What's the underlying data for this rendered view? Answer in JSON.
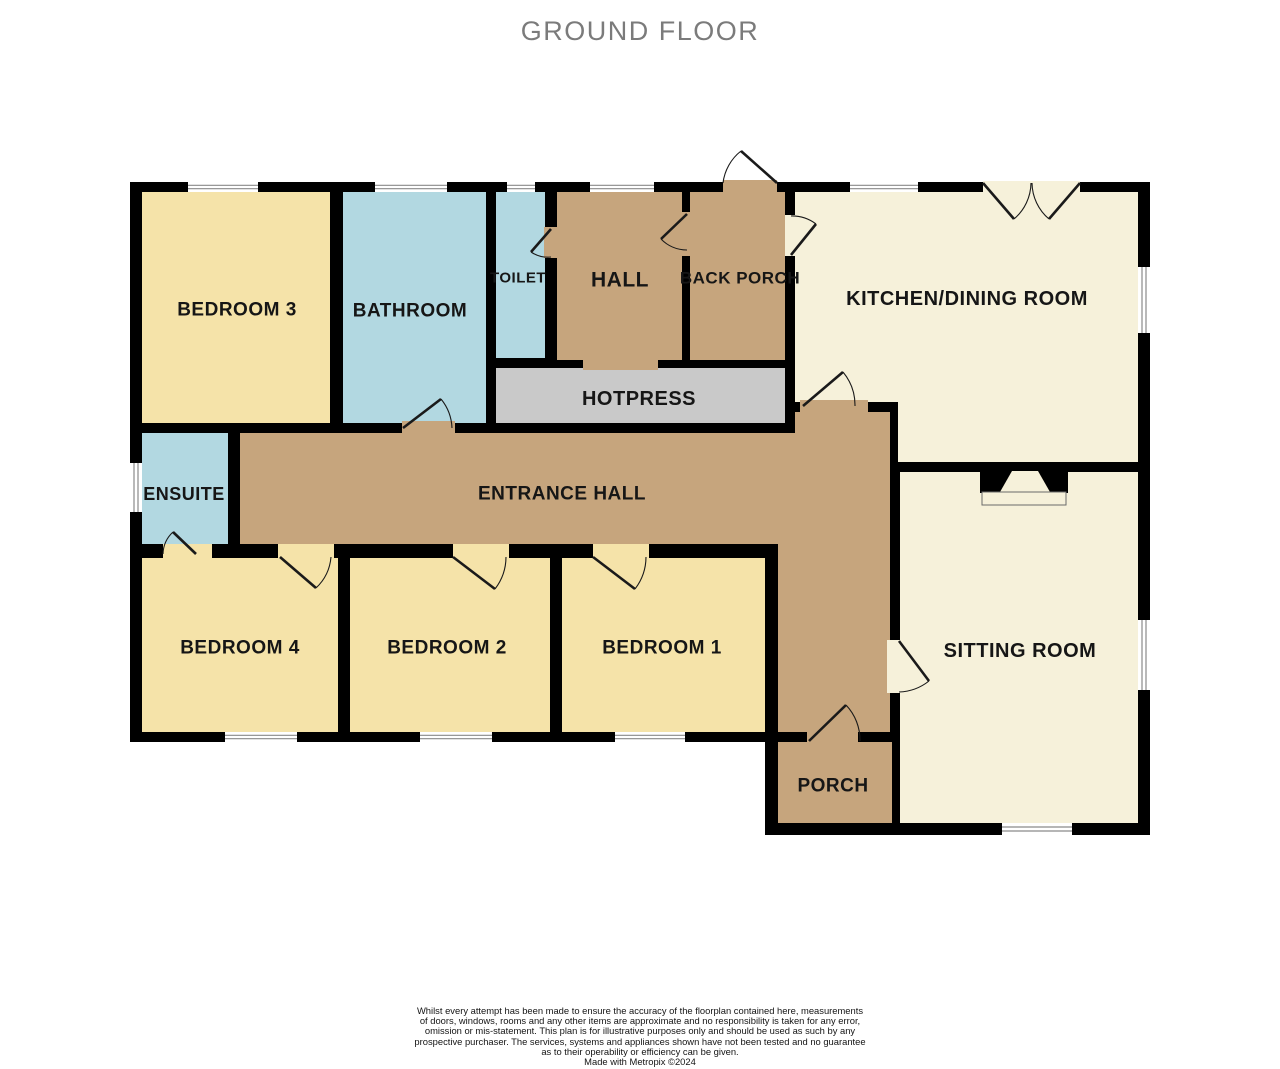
{
  "title": "GROUND FLOOR",
  "colors": {
    "wall": "#000000",
    "bedroom": "#F5E3A9",
    "wet": "#B2D8E1",
    "hall": "#C6A57D",
    "living": "#F6F1DA",
    "hotpress": "#C9C9C9",
    "window_frame": "#8a8a8a",
    "label": "#161616",
    "door_line": "#1a1a1a"
  },
  "base_shapes": [
    {
      "x": 130,
      "y": 182,
      "w": 1020,
      "h": 560
    },
    {
      "x": 765,
      "y": 435,
      "w": 385,
      "h": 400
    }
  ],
  "rooms": [
    {
      "id": "bedroom-3",
      "label": "BEDROOM 3",
      "fill": "bedroom",
      "shape": {
        "type": "rect",
        "x": 142,
        "y": 192,
        "w": 188,
        "h": 231
      },
      "label_pos": [
        237,
        310
      ],
      "font": 19
    },
    {
      "id": "bathroom",
      "label": "BATHROOM",
      "fill": "wet",
      "shape": {
        "type": "rect",
        "x": 343,
        "y": 192,
        "w": 143,
        "h": 231
      },
      "label_pos": [
        410,
        311
      ],
      "font": 19
    },
    {
      "id": "toilet",
      "label": "TOILET",
      "fill": "wet",
      "shape": {
        "type": "rect",
        "x": 496,
        "y": 192,
        "w": 49,
        "h": 166
      },
      "label_pos": [
        518,
        278
      ],
      "font": 15
    },
    {
      "id": "hall",
      "label": "HALL",
      "fill": "hall",
      "shape": {
        "type": "rect",
        "x": 557,
        "y": 192,
        "w": 125,
        "h": 168
      },
      "label_pos": [
        620,
        280
      ],
      "font": 21
    },
    {
      "id": "back-porch",
      "label": "BACK  PORCH",
      "fill": "hall",
      "shape": {
        "type": "rect",
        "x": 690,
        "y": 192,
        "w": 95,
        "h": 168
      },
      "label_pos": [
        740,
        278
      ],
      "font": 17
    },
    {
      "id": "kitchen-dining-room",
      "label": "KITCHEN/DINING ROOM",
      "fill": "living",
      "shape": {
        "type": "poly",
        "points": [
          [
            795,
            192
          ],
          [
            1138,
            192
          ],
          [
            1138,
            462
          ],
          [
            898,
            462
          ],
          [
            898,
            402
          ],
          [
            795,
            402
          ]
        ]
      },
      "label_pos": [
        967,
        299
      ],
      "font": 20
    },
    {
      "id": "hotpress",
      "label": "HOTPRESS",
      "fill": "hotpress",
      "shape": {
        "type": "rect",
        "x": 496,
        "y": 368,
        "w": 289,
        "h": 55
      },
      "label_pos": [
        639,
        399
      ],
      "font": 20
    },
    {
      "id": "ensuite",
      "label": "ENSUITE",
      "fill": "wet",
      "shape": {
        "type": "rect",
        "x": 142,
        "y": 433,
        "w": 86,
        "h": 111
      },
      "label_pos": [
        184,
        494
      ],
      "font": 18
    },
    {
      "id": "entrance-hall",
      "label": "ENTRANCE HALL",
      "fill": "hall",
      "shape": {
        "type": "poly",
        "points": [
          [
            240,
            433
          ],
          [
            795,
            433
          ],
          [
            795,
            412
          ],
          [
            890,
            412
          ],
          [
            890,
            732
          ],
          [
            778,
            732
          ],
          [
            778,
            544
          ],
          [
            240,
            544
          ]
        ]
      },
      "label_pos": [
        562,
        494
      ],
      "font": 19
    },
    {
      "id": "bedroom-4",
      "label": "BEDROOM 4",
      "fill": "bedroom",
      "shape": {
        "type": "rect",
        "x": 142,
        "y": 558,
        "w": 196,
        "h": 174
      },
      "label_pos": [
        240,
        648
      ],
      "font": 19
    },
    {
      "id": "bedroom-2",
      "label": "BEDROOM 2",
      "fill": "bedroom",
      "shape": {
        "type": "rect",
        "x": 350,
        "y": 558,
        "w": 200,
        "h": 174
      },
      "label_pos": [
        447,
        648
      ],
      "font": 19
    },
    {
      "id": "bedroom-1",
      "label": "BEDROOM 1",
      "fill": "bedroom",
      "shape": {
        "type": "rect",
        "x": 562,
        "y": 558,
        "w": 203,
        "h": 174
      },
      "label_pos": [
        662,
        648
      ],
      "font": 19
    },
    {
      "id": "porch",
      "label": "PORCH",
      "fill": "hall",
      "shape": {
        "type": "rect",
        "x": 778,
        "y": 742,
        "w": 114,
        "h": 81
      },
      "label_pos": [
        833,
        786
      ],
      "font": 19
    },
    {
      "id": "sitting-room",
      "label": "SITTING ROOM",
      "fill": "living",
      "shape": {
        "type": "rect",
        "x": 900,
        "y": 472,
        "w": 238,
        "h": 351
      },
      "label_pos": [
        1020,
        651
      ],
      "font": 20
    }
  ],
  "door_openings": [
    {
      "x": 723,
      "y": 180,
      "w": 54,
      "h": 13,
      "fill": "hall"
    },
    {
      "x": 544,
      "y": 227,
      "w": 14,
      "h": 31,
      "fill": "hall"
    },
    {
      "x": 681,
      "y": 212,
      "w": 14,
      "h": 44,
      "fill": "hall"
    },
    {
      "x": 785,
      "y": 215,
      "w": 11,
      "h": 41,
      "fill": "living"
    },
    {
      "x": 402,
      "y": 421,
      "w": 53,
      "h": 14,
      "fill": "hall"
    },
    {
      "x": 800,
      "y": 400,
      "w": 68,
      "h": 14,
      "fill": "hall"
    },
    {
      "x": 163,
      "y": 544,
      "w": 49,
      "h": 15,
      "fill": "bedroom"
    },
    {
      "x": 278,
      "y": 544,
      "w": 56,
      "h": 15,
      "fill": "bedroom"
    },
    {
      "x": 453,
      "y": 544,
      "w": 56,
      "h": 15,
      "fill": "bedroom"
    },
    {
      "x": 593,
      "y": 544,
      "w": 56,
      "h": 15,
      "fill": "bedroom"
    },
    {
      "x": 887,
      "y": 640,
      "w": 15,
      "h": 53,
      "fill": "living"
    },
    {
      "x": 807,
      "y": 729,
      "w": 51,
      "h": 14,
      "fill": "hall"
    },
    {
      "x": 583,
      "y": 357,
      "w": 75,
      "h": 13,
      "fill": "hall"
    },
    {
      "x": 983,
      "y": 181,
      "w": 97,
      "h": 12,
      "fill": "living"
    }
  ],
  "doors": [
    {
      "name": "back-porch-exterior-door",
      "hinge": [
        777,
        183
      ],
      "tip": [
        741,
        151
      ],
      "end": [
        723,
        183
      ],
      "r": 48,
      "sweep": 0
    },
    {
      "name": "toilet-door",
      "hinge": [
        551,
        229
      ],
      "tip": [
        531,
        252
      ],
      "end": [
        551,
        257
      ],
      "r": 30,
      "sweep": 0
    },
    {
      "name": "hall-back-porch-door",
      "hinge": [
        687,
        214
      ],
      "tip": [
        661,
        239
      ],
      "end": [
        687,
        250
      ],
      "r": 36,
      "sweep": 0
    },
    {
      "name": "back-porch-kitchen-door",
      "hinge": [
        791,
        255
      ],
      "tip": [
        816,
        224
      ],
      "end": [
        791,
        216
      ],
      "r": 40,
      "sweep": 0
    },
    {
      "name": "bathroom-door",
      "hinge": [
        403,
        428
      ],
      "tip": [
        441,
        399
      ],
      "end": [
        452,
        428
      ],
      "r": 49,
      "sweep": 1
    },
    {
      "name": "kitchen-hall-door",
      "hinge": [
        803,
        406
      ],
      "tip": [
        843,
        372
      ],
      "end": [
        855,
        406
      ],
      "r": 52,
      "sweep": 1
    },
    {
      "name": "ensuite-door",
      "hinge": [
        196,
        554
      ],
      "tip": [
        173,
        532
      ],
      "end": [
        163,
        554
      ],
      "r": 31,
      "sweep": 0
    },
    {
      "name": "bedroom-4-door",
      "hinge": [
        280,
        557
      ],
      "tip": [
        316,
        588
      ],
      "end": [
        331,
        557
      ],
      "r": 48,
      "sweep": 0
    },
    {
      "name": "bedroom-2-door",
      "hinge": [
        453,
        557
      ],
      "tip": [
        495,
        589
      ],
      "end": [
        506,
        557
      ],
      "r": 53,
      "sweep": 0
    },
    {
      "name": "bedroom-1-door",
      "hinge": [
        593,
        557
      ],
      "tip": [
        635,
        589
      ],
      "end": [
        646,
        557
      ],
      "r": 53,
      "sweep": 0
    },
    {
      "name": "sitting-room-door",
      "hinge": [
        899,
        641
      ],
      "tip": [
        929,
        681
      ],
      "end": [
        899,
        692
      ],
      "r": 51,
      "sweep": 1
    },
    {
      "name": "porch-door",
      "hinge": [
        809,
        741
      ],
      "tip": [
        846,
        705
      ],
      "end": [
        860,
        741
      ],
      "r": 51,
      "sweep": 1
    },
    {
      "name": "kitchen-double-door-left",
      "hinge": [
        983,
        183
      ],
      "tip": [
        1014,
        219
      ],
      "end": [
        1031,
        183
      ],
      "r": 48,
      "sweep": 0
    },
    {
      "name": "kitchen-double-door-right",
      "hinge": [
        1080,
        183
      ],
      "tip": [
        1049,
        219
      ],
      "end": [
        1032,
        183
      ],
      "r": 48,
      "sweep": 1
    }
  ],
  "windows": [
    {
      "x": 188,
      "y": 182,
      "w": 70,
      "h": 10,
      "dir": "h"
    },
    {
      "x": 375,
      "y": 182,
      "w": 72,
      "h": 10,
      "dir": "h"
    },
    {
      "x": 507,
      "y": 182,
      "w": 28,
      "h": 10,
      "dir": "h"
    },
    {
      "x": 590,
      "y": 182,
      "w": 64,
      "h": 10,
      "dir": "h"
    },
    {
      "x": 850,
      "y": 182,
      "w": 68,
      "h": 10,
      "dir": "h"
    },
    {
      "x": 1138,
      "y": 267,
      "w": 12,
      "h": 66,
      "dir": "v"
    },
    {
      "x": 1138,
      "y": 620,
      "w": 12,
      "h": 70,
      "dir": "v"
    },
    {
      "x": 1002,
      "y": 823,
      "w": 70,
      "h": 12,
      "dir": "h"
    },
    {
      "x": 615,
      "y": 732,
      "w": 70,
      "h": 10,
      "dir": "h"
    },
    {
      "x": 420,
      "y": 732,
      "w": 72,
      "h": 10,
      "dir": "h"
    },
    {
      "x": 225,
      "y": 732,
      "w": 72,
      "h": 10,
      "dir": "h"
    },
    {
      "x": 130,
      "y": 463,
      "w": 12,
      "h": 49,
      "dir": "v"
    }
  ],
  "fireplace": {
    "block": {
      "x": 980,
      "y": 470,
      "w": 88,
      "h": 23
    },
    "notch_points": [
      [
        1012,
        471
      ],
      [
        1038,
        471
      ],
      [
        1050,
        492
      ],
      [
        1000,
        492
      ]
    ],
    "hearth": {
      "x": 982,
      "y": 492,
      "w": 84,
      "h": 13
    }
  },
  "disclaimer_lines": [
    "Whilst every attempt has been made to ensure the accuracy of the floorplan contained here, measurements",
    "of doors, windows, rooms and any other items are approximate and no responsibility is taken for any error,",
    "omission or mis-statement. This plan is for illustrative purposes only and should be used as such by any",
    "prospective purchaser. The services, systems and appliances shown have not been tested and no guarantee",
    "as to their operability or efficiency can be given.",
    "Made with Metropix ©2024"
  ]
}
